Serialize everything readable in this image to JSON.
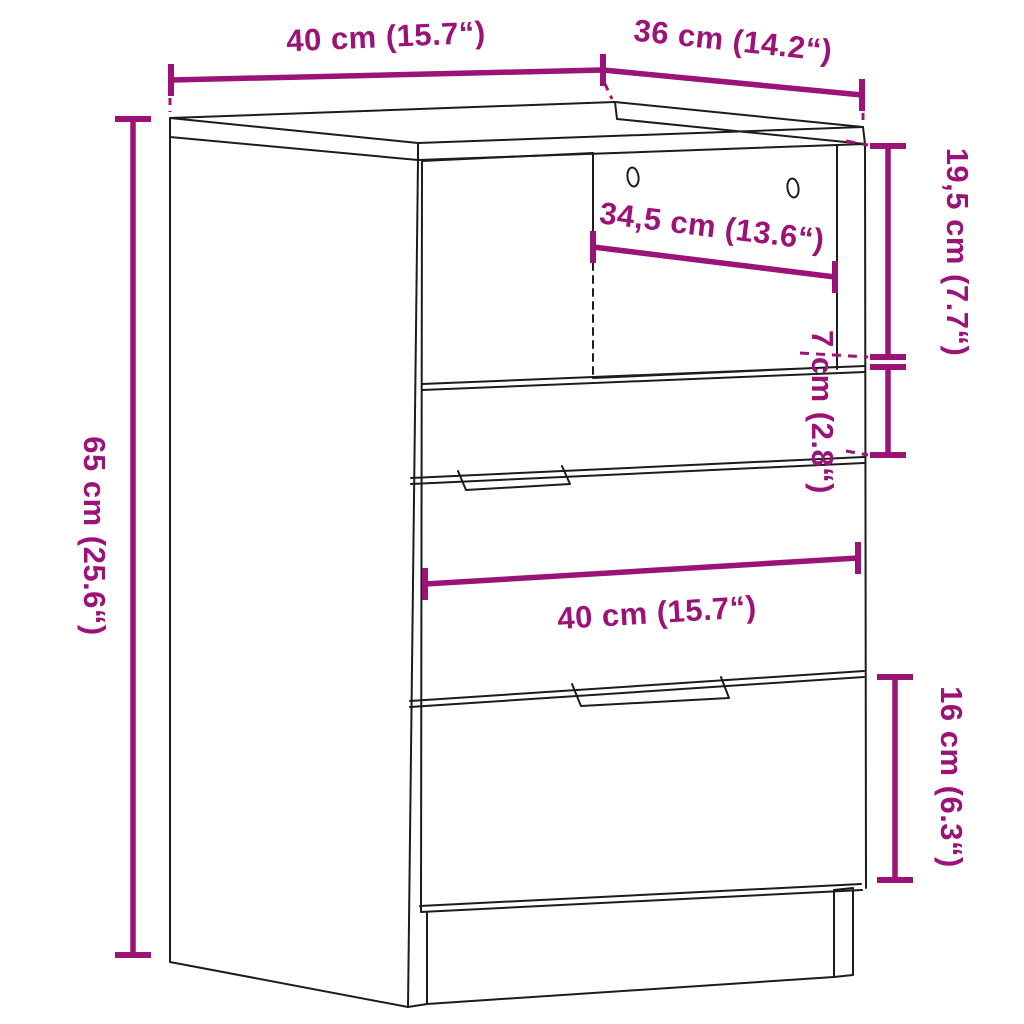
{
  "figure": {
    "title": "cabinet-dimension-diagram",
    "product": "three-drawer bedside cabinet with open niche",
    "accent_color": "#9B1377",
    "line_color": "#1c1c1c",
    "background": "#ffffff",
    "dimensions": [
      {
        "id": "top-width",
        "label": "40 cm (15.7“)"
      },
      {
        "id": "top-depth",
        "label": "36 cm (14.2“)"
      },
      {
        "id": "height",
        "label": "65 cm (25.6“)"
      },
      {
        "id": "niche-height",
        "label": "19,5 cm (7.7“)"
      },
      {
        "id": "drawer1-height",
        "label": "7 cm (2.8“)"
      },
      {
        "id": "niche-width",
        "label": "34,5 cm (13.6“)"
      },
      {
        "id": "front-width",
        "label": "40 cm (15.7“)"
      },
      {
        "id": "drawer3-height",
        "label": "16 cm (6.3“)"
      }
    ]
  }
}
